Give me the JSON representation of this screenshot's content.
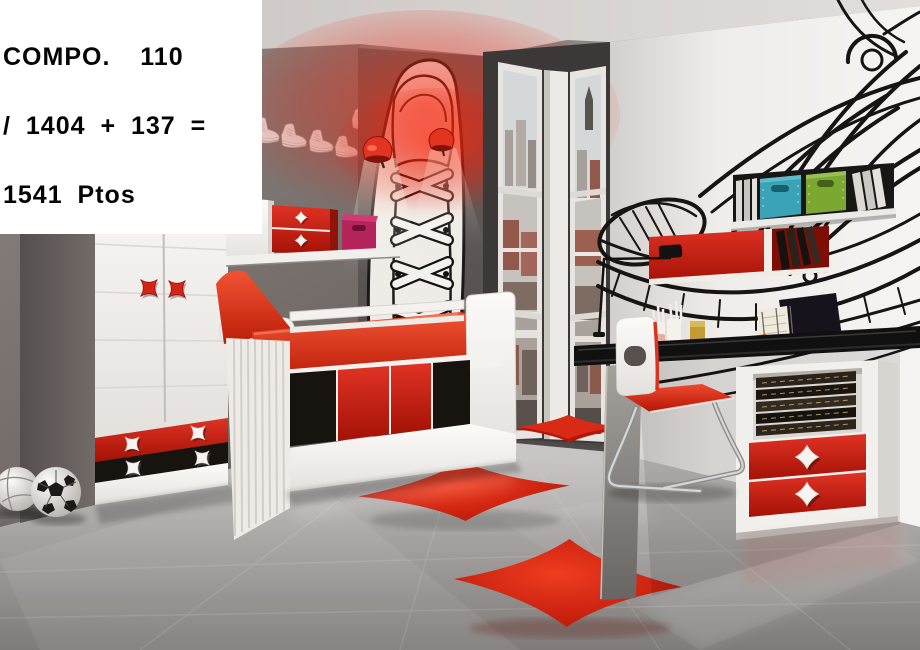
{
  "overlay": {
    "line1": "COMPO.  110",
    "line2": "/ 1404 + 137 =",
    "line3": "1541 Ptos"
  },
  "scene": {
    "setting": "kids bedroom furniture composition photo",
    "palette": {
      "accent_red": "#d92c17",
      "furniture_white": "#f2f0ed",
      "left_wall_gray": "#7b7370",
      "partition_gray": "#575250",
      "right_wall_white": "#efedea",
      "floor_gray": "#9b9896",
      "desk_top_black": "#101010",
      "teal_box": "#3aa3b6",
      "green_box": "#7ca832",
      "magenta_box": "#b5245a"
    },
    "items": [
      {
        "name": "sneaker-decals-row",
        "count": 12,
        "color": "white"
      },
      {
        "name": "vertical-sneaker-mural",
        "wall": "partition"
      },
      {
        "name": "red-wall-lamps",
        "count": 2
      },
      {
        "name": "wardrobe",
        "doors": 2,
        "drawers": [
          "red",
          "black"
        ],
        "handles": "red stars"
      },
      {
        "name": "overbed-shelf",
        "drawer_unit": "red",
        "box": "magenta"
      },
      {
        "name": "bed",
        "mattress": "red",
        "underbed_fronts": [
          "black",
          "red",
          "red",
          "black"
        ]
      },
      {
        "name": "corner-windows",
        "view": "city rooftops"
      },
      {
        "name": "giant-sneaker-mural",
        "wall": "right"
      },
      {
        "name": "black-wall-shelf",
        "boxes": [
          "teal",
          "green"
        ]
      },
      {
        "name": "red-wall-cabinet",
        "contents": "books",
        "lamp": "black clamp lamp"
      },
      {
        "name": "desk",
        "top": "black",
        "pedestal_drawers": [
          "red",
          "red"
        ],
        "shelf": "books"
      },
      {
        "name": "chair",
        "back": "white",
        "seat": "red",
        "legs": "chrome sled"
      },
      {
        "name": "star-rugs",
        "count": 3,
        "color": "red"
      },
      {
        "name": "soccer-ball"
      },
      {
        "name": "volleyball"
      }
    ]
  }
}
